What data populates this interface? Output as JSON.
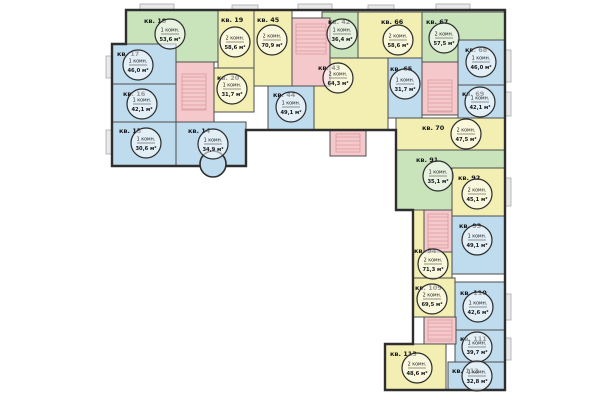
{
  "plan": {
    "name": "Поэтажный план — типовой этаж",
    "area_unit": "м²",
    "apartment_prefix": "кв."
  },
  "colors": {
    "blue": "#bedced",
    "green": "#c9e4bb",
    "yellow": "#f3efb2",
    "core_pink": "#f5c9cb",
    "hatch": "#d99a9e",
    "wall": "#4d4d4d",
    "outline": "#2e2e2e",
    "balcony": "#e9e9e9"
  },
  "units": [
    {
      "id": "kv-14",
      "label": "кв. 14",
      "rooms": "1 комн.",
      "area": "34,9 м²",
      "color": "blue",
      "poly": [
        [
          176,
          122
        ],
        [
          246,
          122
        ],
        [
          246,
          166
        ],
        [
          176,
          166
        ]
      ],
      "label_pos": [
        188,
        128
      ],
      "circle": [
        213,
        144
      ]
    },
    {
      "id": "kv-15",
      "label": "кв. 15",
      "rooms": "1 комн.",
      "area": "30,6 м²",
      "color": "blue",
      "poly": [
        [
          112,
          122
        ],
        [
          176,
          122
        ],
        [
          176,
          166
        ],
        [
          112,
          166
        ]
      ],
      "label_pos": [
        119,
        128
      ],
      "circle": [
        146,
        143
      ]
    },
    {
      "id": "kv-16",
      "label": "кв. 16",
      "rooms": "1 комн.",
      "area": "42,1 м²",
      "color": "blue",
      "poly": [
        [
          112,
          84
        ],
        [
          176,
          84
        ],
        [
          176,
          122
        ],
        [
          112,
          122
        ]
      ],
      "label_pos": [
        123,
        91
      ],
      "circle": [
        142,
        104
      ]
    },
    {
      "id": "kv-17",
      "label": "кв. 17",
      "rooms": "1 комн.",
      "area": "46,0 м²",
      "color": "blue",
      "poly": [
        [
          112,
          44
        ],
        [
          176,
          44
        ],
        [
          176,
          84
        ],
        [
          112,
          84
        ]
      ],
      "label_pos": [
        117,
        51
      ],
      "circle": [
        138,
        65
      ]
    },
    {
      "id": "kv-18",
      "label": "кв. 18",
      "rooms": "1 комн.",
      "area": "53,6 м²",
      "color": "green",
      "poly": [
        [
          126,
          10
        ],
        [
          218,
          10
        ],
        [
          218,
          62
        ],
        [
          176,
          62
        ],
        [
          176,
          44
        ],
        [
          126,
          44
        ]
      ],
      "label_pos": [
        144,
        18
      ],
      "circle": [
        170,
        34
      ]
    },
    {
      "id": "kv-19",
      "label": "кв. 19",
      "rooms": "2 комн.",
      "area": "58,6 м²",
      "color": "yellow",
      "poly": [
        [
          218,
          10
        ],
        [
          254,
          10
        ],
        [
          254,
          68
        ],
        [
          218,
          68
        ]
      ],
      "label_pos": [
        221,
        17
      ],
      "circle": [
        235,
        42
      ]
    },
    {
      "id": "kv-20",
      "label": "кв. 20",
      "rooms": "1 комн.",
      "area": "31,7 м²",
      "color": "yellow",
      "poly": [
        [
          214,
          68
        ],
        [
          254,
          68
        ],
        [
          254,
          112
        ],
        [
          214,
          112
        ]
      ],
      "label_pos": [
        217,
        75
      ],
      "circle": [
        232,
        89
      ]
    },
    {
      "id": "kv-45",
      "label": "кв. 45",
      "rooms": "2 комн.",
      "area": "70,9 м²",
      "color": "yellow",
      "poly": [
        [
          254,
          10
        ],
        [
          292,
          10
        ],
        [
          292,
          86
        ],
        [
          254,
          86
        ]
      ],
      "label_pos": [
        257,
        17
      ],
      "circle": [
        272,
        40
      ]
    },
    {
      "id": "kv-44",
      "label": "кв. 44",
      "rooms": "1 комн.",
      "area": "49,1 м²",
      "color": "blue",
      "poly": [
        [
          268,
          86
        ],
        [
          314,
          86
        ],
        [
          314,
          130
        ],
        [
          268,
          130
        ]
      ],
      "label_pos": [
        273,
        92
      ],
      "circle": [
        291,
        107
      ]
    },
    {
      "id": "kv-43",
      "label": "кв. 43",
      "rooms": "2 комн.",
      "area": "64,3 м²",
      "color": "yellow",
      "poly": [
        [
          314,
          58
        ],
        [
          388,
          58
        ],
        [
          388,
          130
        ],
        [
          314,
          130
        ]
      ],
      "label_pos": [
        318,
        65
      ],
      "circle": [
        338,
        78
      ]
    },
    {
      "id": "kv-42",
      "label": "кв. 42",
      "rooms": "1 комн.",
      "area": "36,4 м²",
      "color": "green",
      "poly": [
        [
          322,
          12
        ],
        [
          358,
          12
        ],
        [
          358,
          58
        ],
        [
          322,
          58
        ]
      ],
      "label_pos": [
        328,
        19
      ],
      "circle": [
        342,
        34
      ]
    },
    {
      "id": "kv-66",
      "label": "кв. 66",
      "rooms": "2 комн.",
      "area": "58,6 м²",
      "color": "yellow",
      "poly": [
        [
          358,
          12
        ],
        [
          422,
          12
        ],
        [
          422,
          58
        ],
        [
          358,
          58
        ]
      ],
      "label_pos": [
        381,
        19
      ],
      "circle": [
        398,
        40
      ]
    },
    {
      "id": "kv-67",
      "label": "кв. 67",
      "rooms": "2 комн.",
      "area": "57,5 м²",
      "color": "green",
      "poly": [
        [
          422,
          12
        ],
        [
          505,
          12
        ],
        [
          505,
          40
        ],
        [
          458,
          40
        ],
        [
          458,
          62
        ],
        [
          422,
          62
        ]
      ],
      "label_pos": [
        426,
        19
      ],
      "circle": [
        444,
        38
      ]
    },
    {
      "id": "kv-68",
      "label": "кв. 68",
      "rooms": "1 комн.",
      "area": "46,0 м²",
      "color": "blue",
      "poly": [
        [
          458,
          40
        ],
        [
          505,
          40
        ],
        [
          505,
          85
        ],
        [
          458,
          85
        ]
      ],
      "label_pos": [
        465,
        47
      ],
      "circle": [
        481,
        62
      ]
    },
    {
      "id": "kv-65",
      "label": "кв. 65",
      "rooms": "1 комн.",
      "area": "31,7 м²",
      "color": "blue",
      "poly": [
        [
          388,
          58
        ],
        [
          422,
          58
        ],
        [
          422,
          118
        ],
        [
          388,
          118
        ]
      ],
      "label_pos": [
        390,
        66
      ],
      "circle": [
        405,
        84
      ]
    },
    {
      "id": "kv-69",
      "label": "кв. 69",
      "rooms": "1 комн.",
      "area": "42,1 м²",
      "color": "blue",
      "poly": [
        [
          458,
          85
        ],
        [
          505,
          85
        ],
        [
          505,
          118
        ],
        [
          458,
          118
        ]
      ],
      "label_pos": [
        462,
        91
      ],
      "circle": [
        480,
        102
      ]
    },
    {
      "id": "kv-70",
      "label": "кв. 70",
      "rooms": "2 комн.",
      "area": "47,5 м²",
      "color": "yellow",
      "poly": [
        [
          396,
          118
        ],
        [
          505,
          118
        ],
        [
          505,
          150
        ],
        [
          396,
          150
        ]
      ],
      "label_pos": [
        422,
        125
      ],
      "circle": [
        466,
        134
      ]
    },
    {
      "id": "kv-91",
      "label": "кв. 91",
      "rooms": "1 комн.",
      "area": "35,1 м²",
      "color": "green",
      "poly": [
        [
          396,
          150
        ],
        [
          505,
          150
        ],
        [
          505,
          168
        ],
        [
          452,
          168
        ],
        [
          452,
          210
        ],
        [
          396,
          210
        ]
      ],
      "label_pos": [
        416,
        157
      ],
      "circle": [
        438,
        176
      ]
    },
    {
      "id": "kv-92",
      "label": "кв. 92",
      "rooms": "2 комн.",
      "area": "45,1 м²",
      "color": "yellow",
      "poly": [
        [
          452,
          168
        ],
        [
          505,
          168
        ],
        [
          505,
          216
        ],
        [
          452,
          216
        ]
      ],
      "label_pos": [
        458,
        175
      ],
      "circle": [
        477,
        194
      ]
    },
    {
      "id": "kv-93",
      "label": "кв. 93",
      "rooms": "1 комн.",
      "area": "49,1 м²",
      "color": "blue",
      "poly": [
        [
          452,
          216
        ],
        [
          505,
          216
        ],
        [
          505,
          274
        ],
        [
          452,
          274
        ]
      ],
      "label_pos": [
        459,
        223
      ],
      "circle": [
        477,
        240
      ]
    },
    {
      "id": "kv-94",
      "label": "кв. 94",
      "rooms": "2 комн.",
      "area": "71,3 м²",
      "color": "yellow",
      "poly": [
        [
          413,
          210
        ],
        [
          424,
          210
        ],
        [
          424,
          252
        ],
        [
          452,
          252
        ],
        [
          452,
          278
        ],
        [
          413,
          278
        ]
      ],
      "label_pos": [
        414,
        248
      ],
      "circle": [
        433,
        264
      ]
    },
    {
      "id": "kv-109",
      "label": "кв. 109",
      "rooms": "2 комн.",
      "area": "69,5 м²",
      "color": "yellow",
      "poly": [
        [
          413,
          278
        ],
        [
          455,
          278
        ],
        [
          455,
          317
        ],
        [
          413,
          317
        ]
      ],
      "label_pos": [
        415,
        285
      ],
      "circle": [
        432,
        299
      ]
    },
    {
      "id": "kv-110",
      "label": "кв. 110",
      "rooms": "1 комн.",
      "area": "42,6 м²",
      "color": "blue",
      "poly": [
        [
          455,
          282
        ],
        [
          505,
          282
        ],
        [
          505,
          330
        ],
        [
          455,
          330
        ]
      ],
      "label_pos": [
        460,
        290
      ],
      "circle": [
        478,
        307
      ]
    },
    {
      "id": "kv-111",
      "label": "кв. 111",
      "rooms": "1 комн.",
      "area": "39,7 м²",
      "color": "blue",
      "poly": [
        [
          455,
          330
        ],
        [
          505,
          330
        ],
        [
          505,
          362
        ],
        [
          455,
          362
        ]
      ],
      "label_pos": [
        460,
        336
      ],
      "circle": [
        477,
        347
      ]
    },
    {
      "id": "kv-112",
      "label": "кв. 112",
      "rooms": "1 комн.",
      "area": "32,8 м²",
      "color": "blue",
      "poly": [
        [
          448,
          362
        ],
        [
          505,
          362
        ],
        [
          505,
          390
        ],
        [
          448,
          390
        ]
      ],
      "label_pos": [
        452,
        368
      ],
      "circle": [
        477,
        376
      ]
    },
    {
      "id": "kv-113",
      "label": "кв. 113",
      "rooms": "2 комн.",
      "area": "48,6 м²",
      "color": "yellow",
      "poly": [
        [
          385,
          344
        ],
        [
          446,
          344
        ],
        [
          446,
          390
        ],
        [
          385,
          390
        ]
      ],
      "label_pos": [
        390,
        351
      ],
      "circle": [
        417,
        368
      ]
    }
  ],
  "cores": [
    {
      "id": "core-1",
      "poly": [
        [
          176,
          62
        ],
        [
          214,
          62
        ],
        [
          214,
          122
        ],
        [
          176,
          122
        ]
      ],
      "hatch": [
        182,
        74,
        206,
        110
      ]
    },
    {
      "id": "core-2",
      "poly": [
        [
          292,
          18
        ],
        [
          330,
          18
        ],
        [
          330,
          86
        ],
        [
          292,
          86
        ]
      ],
      "hatch": [
        296,
        24,
        326,
        54
      ]
    },
    {
      "id": "core-porch-2",
      "poly": [
        [
          330,
          130
        ],
        [
          366,
          130
        ],
        [
          366,
          156
        ],
        [
          330,
          156
        ]
      ],
      "hatch": [
        336,
        134,
        360,
        152
      ]
    },
    {
      "id": "core-3",
      "poly": [
        [
          422,
          62
        ],
        [
          458,
          62
        ],
        [
          458,
          115
        ],
        [
          422,
          115
        ]
      ],
      "hatch": [
        428,
        80,
        452,
        112
      ]
    },
    {
      "id": "core-4",
      "poly": [
        [
          424,
          210
        ],
        [
          452,
          210
        ],
        [
          452,
          252
        ],
        [
          424,
          252
        ]
      ],
      "hatch": [
        428,
        214,
        448,
        248
      ]
    },
    {
      "id": "core-5",
      "poly": [
        [
          424,
          317
        ],
        [
          456,
          317
        ],
        [
          456,
          344
        ],
        [
          424,
          344
        ]
      ],
      "hatch": [
        428,
        320,
        452,
        341
      ]
    }
  ],
  "bays": [
    {
      "id": "bay-kv-14",
      "color": "blue",
      "cx": 213,
      "cy": 164,
      "r": 13
    }
  ],
  "balconies": [
    [
      140,
      4,
      34,
      8
    ],
    [
      232,
      5,
      26,
      7
    ],
    [
      298,
      4,
      34,
      8
    ],
    [
      368,
      5,
      26,
      7
    ],
    [
      436,
      4,
      34,
      8
    ],
    [
      503,
      50,
      8,
      32
    ],
    [
      503,
      92,
      8,
      24
    ],
    [
      503,
      178,
      8,
      28
    ],
    [
      503,
      294,
      8,
      26
    ],
    [
      503,
      338,
      8,
      22
    ],
    [
      106,
      56,
      6,
      22
    ],
    [
      106,
      130,
      6,
      24
    ]
  ]
}
